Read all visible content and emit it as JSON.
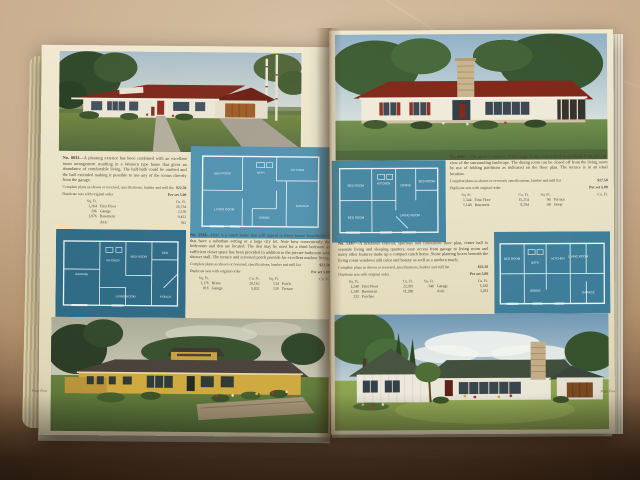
{
  "scene": {
    "description": "Photograph of an open mid-century house plan catalog lying on a marbled tan table; lower corners fall into dark shadow",
    "surface": "marbled tan table top"
  },
  "colors": {
    "table_tan": "#c7ab8b",
    "shadow_brown": "#1f130b",
    "page_cream": "#ece4c8",
    "blueprint_teal": "#4d90ae",
    "blueprint_dark_teal": "#2e6a85",
    "roof_red": "#7c2517",
    "house_yellow": "#cfa93f",
    "lawn_green": "#6f8d48",
    "ink_brown": "#43392a"
  },
  "book": {
    "left_page": {
      "page_label": "Page Four",
      "top_illustration_alt": "white ranch house with dark red hip roof and attached garage among tall trees and birches",
      "bottom_illustration_alt": "long yellow ranch house with low stone planter wall and flower beds",
      "plans": [
        {
          "number": "No. 8832—",
          "description": "A pleasing exterior has been combined with an excellent room arrangement resulting in a Western type home that gives an abundance of comfortable living. The half-bath could be omitted and the hall extended making it possible to use any of the rooms directly from the garage.",
          "plans_line": "Complete plans as shown or reversed, specifications, lumber and mill list",
          "plans_price": "$22.50",
          "dup_line": "Duplicate sets with original order",
          "dup_price": "Per set 5.00",
          "table_headers": [
            "Sq. Ft.",
            "",
            "Cu. Ft."
          ],
          "table_rows": [
            [
              "1,264",
              "First Floor",
              "20,734"
            ],
            [
              "296",
              "Garage",
              "2,378"
            ],
            [
              "1,076",
              "Basement",
              "9,452"
            ],
            [
              "",
              "Attic",
              "782"
            ]
          ],
          "rooms": [
            "BED ROOM",
            "BATH",
            "KITCHEN",
            "LIVING ROOM",
            "DINING",
            "GARAGE"
          ]
        },
        {
          "number": "No. 5144—",
          "description": "Here is a ranch home that will appeal to those future homebuilders that have a suburban setting or a large city lot. Note how conveniently the bedrooms and den are located. The den may be used for a third bedroom as sufficient closet space has been provided in addition to the private bathroom with shower stall. The terrace and screened porch provide for excellent outdoor living.",
          "plans_line": "Complete plans as shown or reversed, specifications, lumber and mill list",
          "plans_price": "$22.50",
          "dup_line": "Duplicate sets with original order",
          "dup_price": "Per set 5.00",
          "table_headers": [
            "Sq. Ft.",
            "",
            "Cu. Ft.",
            "Sq. Ft.",
            "",
            "Cu. Ft."
          ],
          "table_rows": [
            [
              "1,176",
              "Home",
              "20,162",
              "134",
              "Porch",
              ""
            ],
            [
              "816",
              "Garage",
              "5,832",
              "120",
              "Terrace",
              ""
            ]
          ],
          "rooms": [
            "GARAGE",
            "KITCHEN",
            "BED ROOM",
            "LIVING ROOM",
            "DEN",
            "PORCH"
          ]
        }
      ]
    },
    "right_page": {
      "page_label": "Page Five",
      "top_illustration_alt": "white ranch house with dark red roof, central stone chimney and red shutters",
      "bottom_illustration_alt": "white board-and-batten ranch house with stone chimney, attached garage and cypress trees",
      "plans": [
        {
          "number": "No. 8805—",
          "description": "The picture windows in this large living room afford an excellent front and also view of the surrounding landscape. The dining room can be closed off from the living room by use of folding partitions as indicated on the floor plan. The terrace is in an ideal location.",
          "plans_line": "Complete plans as shown or reversed, specifications, lumber and mill list",
          "plans_price": "$17.50",
          "dup_line": "Duplicate sets with original order",
          "dup_price": "Per set 5.00",
          "table_headers": [
            "Sq. Ft.",
            "",
            "Cu. Ft.",
            "Sq. Ft.",
            "",
            "Cu. Ft."
          ],
          "table_rows": [
            [
              "1,344",
              "First Floor",
              "15,214",
              "96",
              "Terrace",
              ""
            ],
            [
              "1,148",
              "Basement",
              "9,294",
              "48",
              "Stoop",
              ""
            ]
          ],
          "rooms": [
            "BED ROOM",
            "KITCHEN",
            "DINING",
            "BED ROOM",
            "BED ROOM",
            "LIVING ROOM"
          ]
        },
        {
          "number": "No. 5147—",
          "description": "A luxurious exterior, spacious and convenient floor plan, center hall to separate living and sleeping quarters, easy access from garage to living room and many other features make up a compact ranch home. Stone planting boxes beneath the living room windows add color and beauty as well as a modern touch.",
          "plans_line": "Complete plans as shown or reversed, specifications, lumber and mill list",
          "plans_price": "$22.50",
          "dup_line": "Duplicate sets with original order",
          "dup_price": "Per set 5.00",
          "table_headers": [
            "Sq. Ft.",
            "",
            "Cu. Ft.",
            "Sq. Ft.",
            "",
            "Cu. Ft."
          ],
          "table_rows": [
            [
              "1,240",
              "First Floor",
              "22,391",
              "346",
              "Garage",
              "5,182"
            ],
            [
              "1,240",
              "Basement",
              "11,280",
              "",
              "Attic",
              "3,281"
            ],
            [
              "232",
              "Porches",
              "",
              "",
              "",
              ""
            ]
          ],
          "rooms": [
            "BED ROOM",
            "BATH",
            "KITCHEN",
            "DINING",
            "LIVING ROOM",
            "GARAGE"
          ]
        }
      ]
    }
  }
}
